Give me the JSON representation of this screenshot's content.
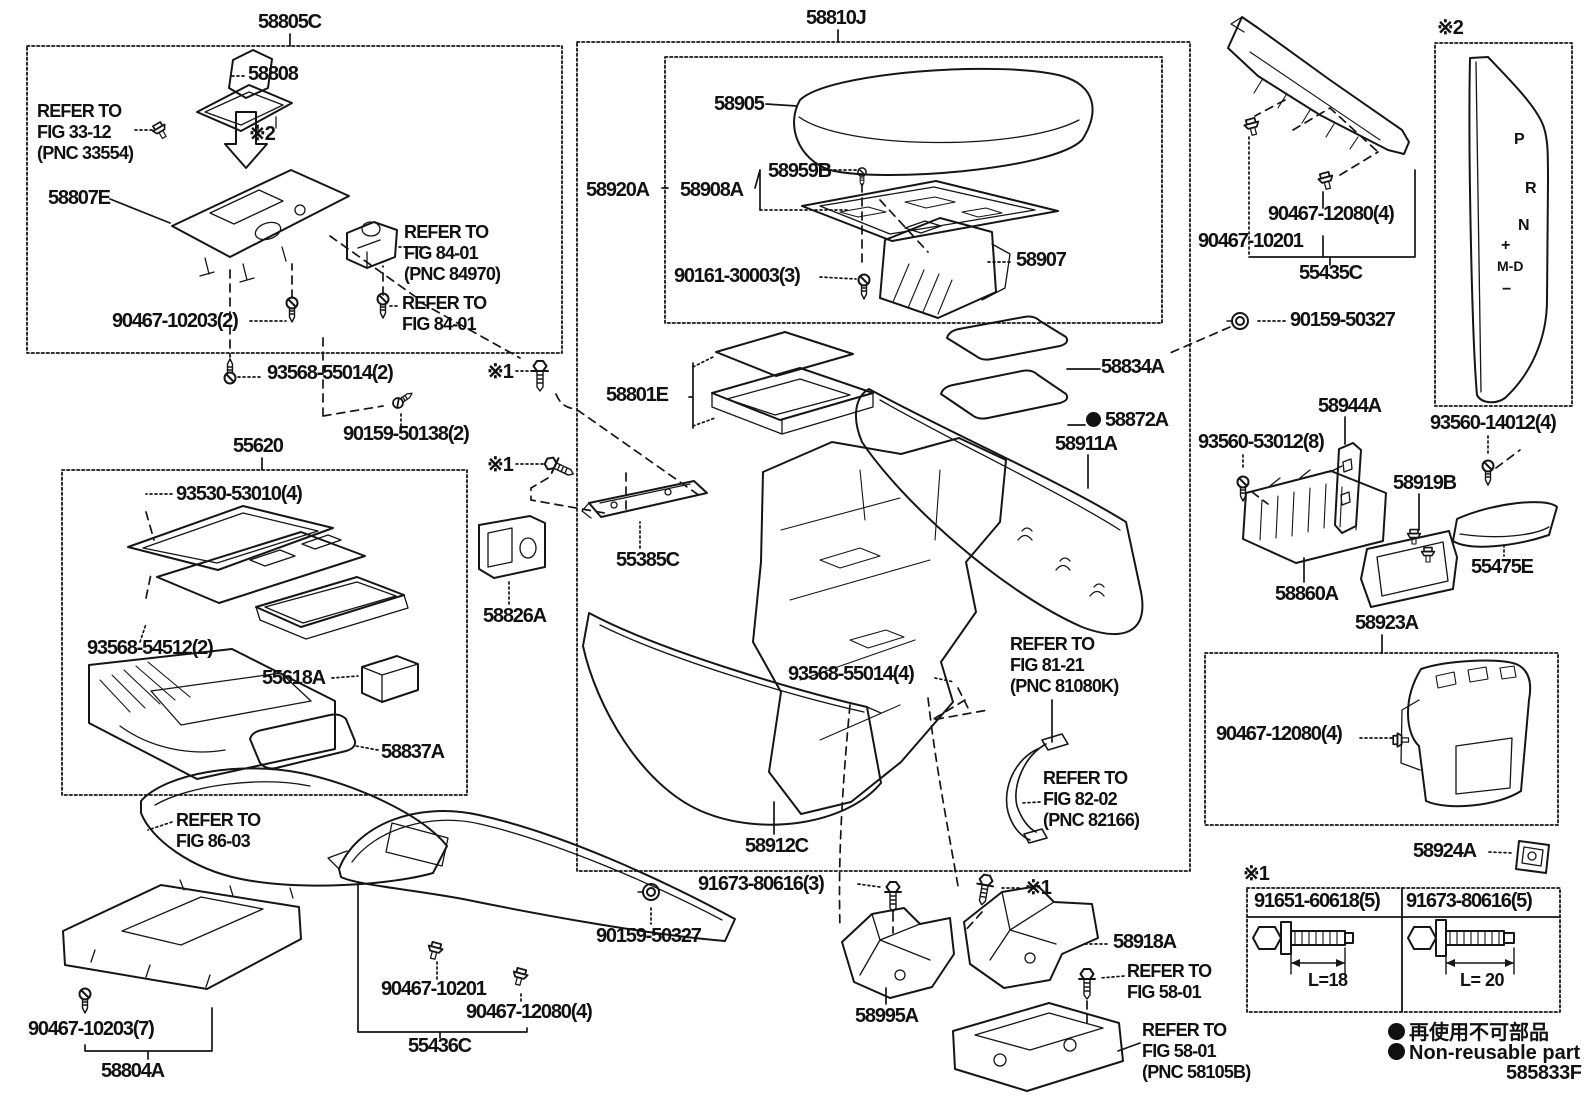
{
  "diagram": {
    "figure_code": "585833F",
    "notes": {
      "n1": "※1",
      "n2": "※2"
    },
    "parts": {
      "p58805C": "58805C",
      "p58808": "58808",
      "p58807E": "58807E",
      "p90467_10203_2": "90467-10203(2)",
      "p93568_55014_2": "93568-55014(2)",
      "p90159_50138_2": "90159-50138(2)",
      "p55620": "55620",
      "p93530_53010_4": "93530-53010(4)",
      "p93568_54512_2": "93568-54512(2)",
      "p55618A": "55618A",
      "p58837A": "58837A",
      "p58826A": "58826A",
      "p55385C": "55385C",
      "p58810J": "58810J",
      "p58905": "58905",
      "p58920A": "58920A",
      "p58908A": "58908A",
      "p58959B": "58959B",
      "p90161_30003_3": "90161-30003(3)",
      "p58907": "58907",
      "p90159_50327_top": "90159-50327",
      "p58834A": "58834A",
      "p58801E": "58801E",
      "p58872A": "58872A",
      "p58911A": "58911A",
      "p93560_53012_8": "93560-53012(8)",
      "p58944A": "58944A",
      "p93560_14012_4": "93560-14012(4)",
      "p58919B": "58919B",
      "p55475E": "55475E",
      "p58860A": "58860A",
      "p58923A": "58923A",
      "p90467_12080_4_box": "90467-12080(4)",
      "p58924A": "58924A",
      "p93568_55014_4": "93568-55014(4)",
      "p58912C": "58912C",
      "p90467_10203_7": "90467-10203(7)",
      "p58804A": "58804A",
      "p90467_10201_btm": "90467-10201",
      "p90467_12080_4_btm": "90467-12080(4)",
      "p55436C": "55436C",
      "p90159_50327_btm": "90159-50327",
      "p91673_80616_3": "91673-80616(3)",
      "p58918A": "58918A",
      "p58995A": "58995A",
      "p90467_12080_4_top": "90467-12080(4)",
      "p90467_10201_top": "90467-10201",
      "p55435C": "55435C"
    },
    "refs": {
      "fig33_12": [
        "REFER TO",
        "FIG 33-12",
        "(PNC 33554)"
      ],
      "fig84_01a": [
        "REFER TO",
        "FIG 84-01",
        "(PNC 84970)"
      ],
      "fig84_01b": [
        "REFER TO",
        "FIG 84-01"
      ],
      "fig86_03": [
        "REFER TO",
        "FIG 86-03"
      ],
      "fig81_21": [
        "REFER TO",
        "FIG 81-21",
        "(PNC 81080K)"
      ],
      "fig82_02": [
        "REFER TO",
        "FIG 82-02",
        "(PNC 82166)"
      ],
      "fig58_01a": [
        "REFER TO",
        "FIG 58-01"
      ],
      "fig58_01b": [
        "REFER TO",
        "FIG 58-01",
        "(PNC 58105B)"
      ]
    },
    "gear_indicator": {
      "p": "P",
      "r": "R",
      "n": "N",
      "plus": "+",
      "md": "M-D",
      "minus": "−"
    },
    "fastener_table": {
      "note": "※1",
      "columns": [
        {
          "part": "91651-60618(5)",
          "length": "L=18"
        },
        {
          "part": "91673-80616(5)",
          "length": "L= 20"
        }
      ]
    },
    "legend": {
      "ja": "再使用不可部品",
      "en": "Non-reusable part"
    }
  }
}
